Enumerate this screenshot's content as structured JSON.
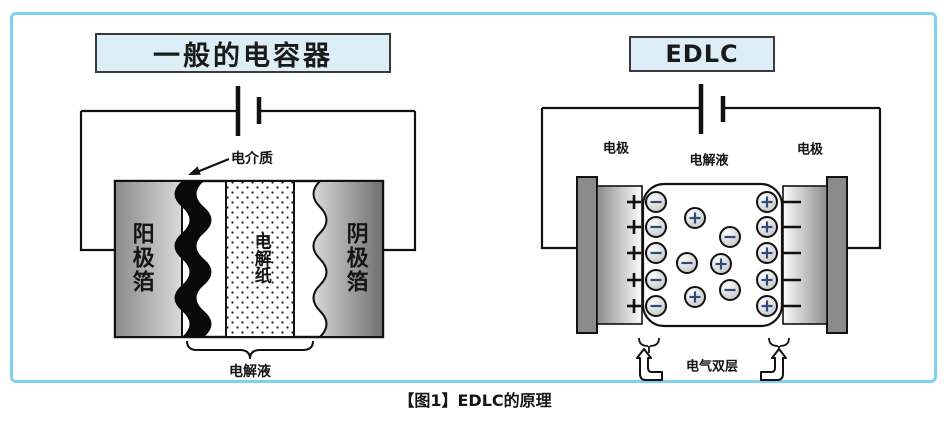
{
  "figure": {
    "caption": "【图1】EDLC的原理"
  },
  "left_diagram": {
    "title": "一般的电容器",
    "labels": {
      "dielectric": "电介质",
      "anode_foil": "阳极箔",
      "electrolytic_paper": "电解纸",
      "cathode_foil": "阴极箔",
      "electrolyte": "电解液"
    }
  },
  "right_diagram": {
    "title": "EDLC",
    "labels": {
      "electrode_left": "电极",
      "electrolyte": "电解液",
      "electrode_right": "电极",
      "electric_double_layer": "电气双层"
    },
    "electrode_marks": {
      "left_sign": "+",
      "right_sign": "−",
      "left_x": 634,
      "right_tick_x1": 783,
      "right_tick_x2": 801,
      "ys": [
        202,
        227,
        253,
        280,
        306
      ]
    },
    "ions": [
      {
        "x": 656,
        "y": 202,
        "sign": "-"
      },
      {
        "x": 656,
        "y": 227,
        "sign": "-"
      },
      {
        "x": 656,
        "y": 253,
        "sign": "-"
      },
      {
        "x": 656,
        "y": 280,
        "sign": "-"
      },
      {
        "x": 656,
        "y": 306,
        "sign": "-"
      },
      {
        "x": 767,
        "y": 202,
        "sign": "+"
      },
      {
        "x": 767,
        "y": 227,
        "sign": "+"
      },
      {
        "x": 767,
        "y": 253,
        "sign": "+"
      },
      {
        "x": 767,
        "y": 280,
        "sign": "+"
      },
      {
        "x": 767,
        "y": 306,
        "sign": "+"
      },
      {
        "x": 695,
        "y": 218,
        "sign": "+"
      },
      {
        "x": 730,
        "y": 237,
        "sign": "-"
      },
      {
        "x": 687,
        "y": 263,
        "sign": "-"
      },
      {
        "x": 721,
        "y": 264,
        "sign": "+"
      },
      {
        "x": 730,
        "y": 290,
        "sign": "-"
      },
      {
        "x": 695,
        "y": 297,
        "sign": "+"
      }
    ]
  },
  "colors": {
    "border": "#7dd2f0",
    "title_box_bg": "#dceef8",
    "line": "#111111",
    "ion_sign": "#2f4a78"
  }
}
